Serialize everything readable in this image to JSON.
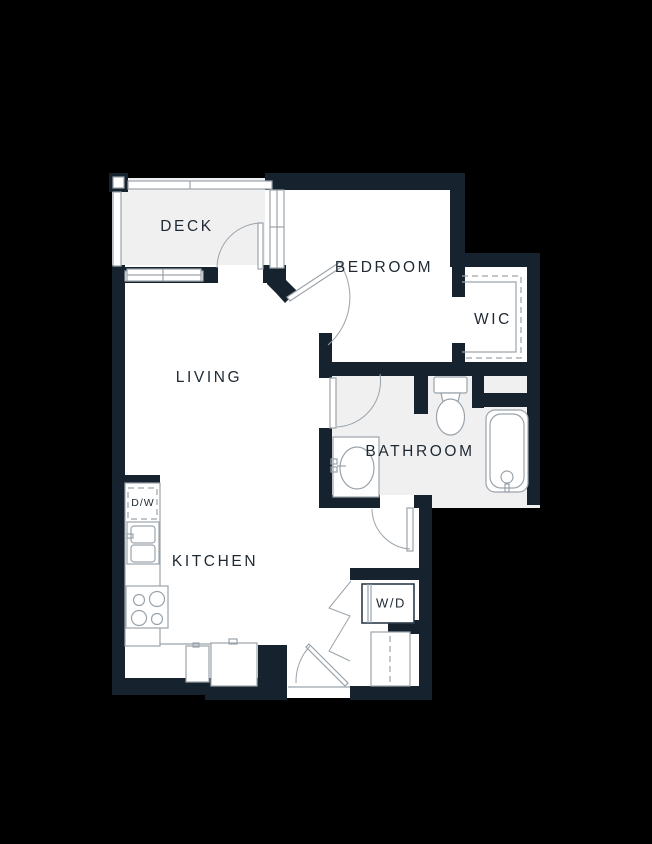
{
  "floorplan": {
    "title": "apartment-unit-floor-plan",
    "rooms": [
      {
        "id": "deck",
        "label": "DECK"
      },
      {
        "id": "bedroom",
        "label": "BEDROOM"
      },
      {
        "id": "wic",
        "label": "WIC"
      },
      {
        "id": "living",
        "label": "LIVING"
      },
      {
        "id": "bathroom",
        "label": "BATHROOM"
      },
      {
        "id": "kitchen",
        "label": "KITCHEN"
      }
    ],
    "appliances": {
      "washer_dryer_label": "W/D",
      "dishwasher_label": "D/W"
    },
    "fixtures": [
      "toilet",
      "bathtub",
      "bathroom-sink",
      "kitchen-sink",
      "stove",
      "refrigerator",
      "deck-railing",
      "windows",
      "door-swings",
      "bifold-doors",
      "closet-rods"
    ],
    "colors": {
      "background": "#000000",
      "wall": "#16232f",
      "room_floor": "#ffffff",
      "deck_bathroom_floor": "#f0f0f1",
      "line": "#9aa3ab",
      "label_text": "#1f2933"
    }
  }
}
